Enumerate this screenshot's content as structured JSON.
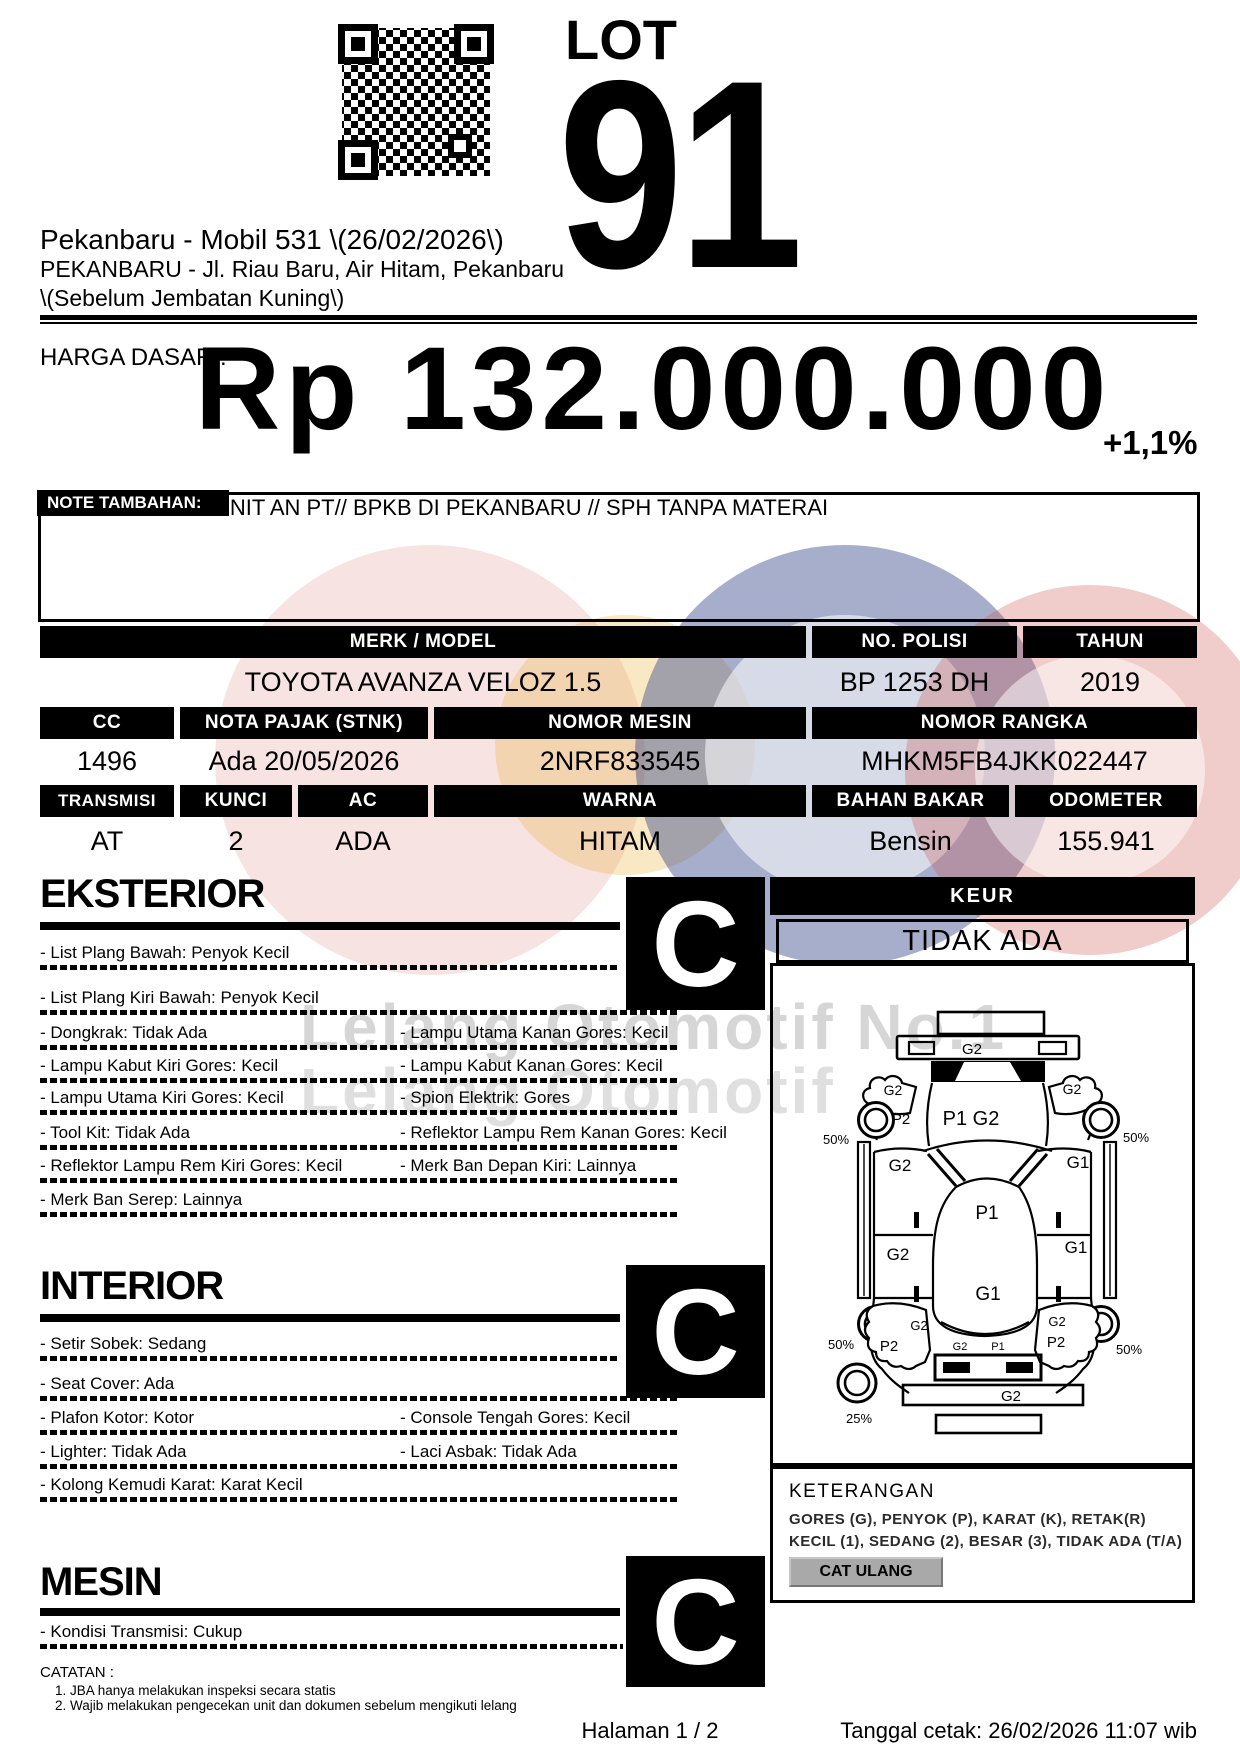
{
  "header": {
    "lot_label": "LOT",
    "lot_number": "91",
    "auction_title": "Pekanbaru - Mobil 531 \\(26/02/2026\\)",
    "address_line1": "PEKANBARU - Jl. Riau Baru, Air Hitam, Pekanbaru",
    "address_line2": "\\(Sebelum Jembatan Kuning\\)"
  },
  "price": {
    "label": "HARGA DASAR :",
    "value": "Rp 132.000.000",
    "change": "+1,1%"
  },
  "note": {
    "label": "NOTE TAMBAHAN:",
    "text": "UNIT AN PT// BPKB DI PEKANBARU // SPH TANPA MATERAI"
  },
  "specs": {
    "row1": {
      "headers": [
        "MERK / MODEL",
        "NO. POLISI",
        "TAHUN"
      ],
      "values": [
        "TOYOTA AVANZA VELOZ 1.5",
        "BP 1253 DH",
        "2019"
      ]
    },
    "row2": {
      "headers": [
        "CC",
        "NOTA PAJAK (STNK)",
        "NOMOR MESIN",
        "NOMOR RANGKA"
      ],
      "values": [
        "1496",
        "Ada 20/05/2026",
        "2NRF833545",
        "MHKM5FB4JKK022447"
      ]
    },
    "row3": {
      "headers": [
        "TRANSMISI",
        "KUNCI",
        "AC",
        "WARNA",
        "BAHAN BAKAR",
        "ODOMETER"
      ],
      "values": [
        "AT",
        "2",
        "ADA",
        "HITAM",
        "Bensin",
        "155.941"
      ]
    }
  },
  "keur": {
    "title": "KEUR",
    "value": "TIDAK ADA"
  },
  "sections": {
    "eksterior": {
      "title": "EKSTERIOR",
      "grade": "C",
      "rows": [
        {
          "left": "- List Plang Bawah: Penyok Kecil",
          "right": ""
        },
        {
          "left": "- List Plang Kiri Bawah: Penyok Kecil",
          "right": ""
        },
        {
          "left": "- Dongkrak: Tidak Ada",
          "right": "- Lampu Utama Kanan Gores: Kecil"
        },
        {
          "left": "- Lampu Kabut Kiri Gores: Kecil",
          "right": "- Lampu Kabut Kanan Gores: Kecil"
        },
        {
          "left": "- Lampu Utama Kiri Gores: Kecil",
          "right": "- Spion Elektrik: Gores"
        },
        {
          "left": "- Tool Kit: Tidak Ada",
          "right": "- Reflektor Lampu Rem Kanan Gores: Kecil"
        },
        {
          "left": "- Reflektor Lampu Rem Kiri Gores: Kecil",
          "right": "- Merk Ban Depan Kiri: Lainnya"
        },
        {
          "left": "- Merk Ban Serep: Lainnya",
          "right": ""
        }
      ]
    },
    "interior": {
      "title": "INTERIOR",
      "grade": "C",
      "rows": [
        {
          "left": "- Setir Sobek: Sedang",
          "right": ""
        },
        {
          "left": "- Seat Cover: Ada",
          "right": ""
        },
        {
          "left": "- Plafon Kotor: Kotor",
          "right": "- Console Tengah Gores: Kecil"
        },
        {
          "left": "- Lighter: Tidak Ada",
          "right": "- Laci Asbak: Tidak Ada"
        },
        {
          "left": "- Kolong Kemudi Karat: Karat Kecil",
          "right": ""
        }
      ]
    },
    "mesin": {
      "title": "MESIN",
      "grade": "C",
      "rows": [
        {
          "left": "- Kondisi Transmisi: Cukup",
          "right": ""
        }
      ]
    }
  },
  "diagram": {
    "front_bumper": "G2",
    "front_fender_left": "G2",
    "front_fender_right": "G2",
    "hood": "P1 G2",
    "front_left_dent": "P2",
    "front_wheel_left_pct": "50%",
    "front_wheel_right_pct": "50%",
    "front_door_left": "G2",
    "front_door_right": "G1",
    "roof_front": "P1",
    "rear_door_left": "G2",
    "rear_door_right": "G1",
    "roof_rear": "G1",
    "rear_fender_left": "G2",
    "rear_fender_left_dent": "P2",
    "rear_fender_right": "G2",
    "rear_fender_right_dent": "P2",
    "rear_wheel_left_pct": "50%",
    "rear_wheel_right_pct": "50%",
    "rear_window_g": "G2",
    "rear_window_p": "P1",
    "rear_bumper": "G2",
    "spare_tire_pct": "25%"
  },
  "keterangan": {
    "title": "KETERANGAN",
    "line1": "GORES (G), PENYOK (P), KARAT (K), RETAK(R)",
    "line2": "KECIL (1), SEDANG (2), BESAR (3), TIDAK ADA (T/A)",
    "button": "CAT ULANG"
  },
  "catatan": {
    "title": "CATATAN :",
    "items": [
      "1. JBA hanya melakukan inspeksi secara statis",
      "2. Wajib melakukan pengecekan unit dan dokumen sebelum mengikuti lelang"
    ]
  },
  "footer": {
    "page": "Halaman 1 / 2",
    "printed": "Tanggal cetak: 26/02/2026 11:07 wib"
  },
  "watermark": {
    "line1": "Lelang Otomotif No.1",
    "line2": "Lelang Otomotif"
  },
  "colors": {
    "wm_red": "rgba(205,85,80,0.30)",
    "wm_pink": "rgba(220,130,125,0.22)",
    "wm_navy": "rgba(45,62,130,0.42)",
    "wm_yellow": "rgba(232,182,70,0.32)"
  }
}
